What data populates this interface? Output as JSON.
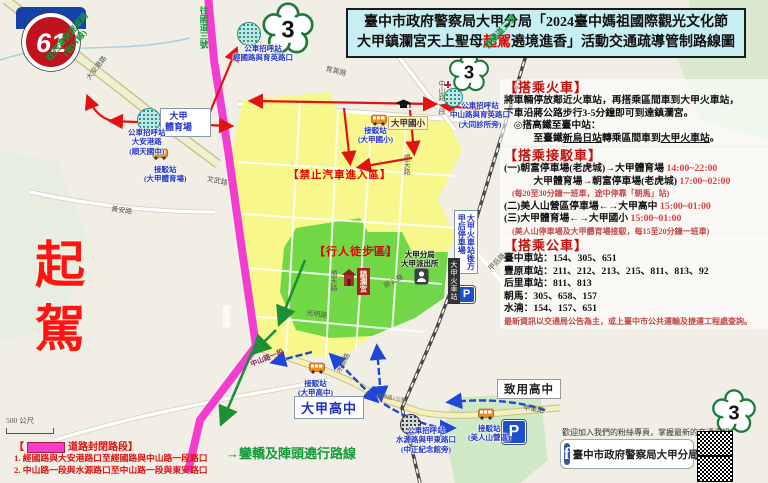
{
  "title": {
    "line1": "臺中市政府警察局大甲分局「2024臺中媽祖國際觀光文化節",
    "line2_pre": "大甲鎮瀾宮天上聖母",
    "line2_red": "起駕",
    "line2_post": "遶境進香」活動交通疏導管制路線圖"
  },
  "badges": {
    "expressway": "61",
    "freeway": "3"
  },
  "big_label": {
    "text": "起駕"
  },
  "panels": [
    {
      "id": "train",
      "header": "【搭乘火車】",
      "lines": [
        {
          "segs": [
            [
              "將車輛停放鄰近火車站，再搭乘區間車到大甲火車站，",
              "k"
            ]
          ]
        },
        {
          "segs": [
            [
              "下車沿蔣公路步行3-5分鐘即可到達鎮瀾宮。",
              "k"
            ]
          ]
        },
        {
          "segs": [
            [
              "　◎搭高鐵至臺中站：",
              "k"
            ]
          ]
        },
        {
          "segs": [
            [
              "　　　至臺鐵",
              "k"
            ],
            [
              "新烏日站",
              "u"
            ],
            [
              "轉乘區間車到",
              "k"
            ],
            [
              "大甲火車站",
              "u"
            ],
            [
              "。",
              "k"
            ]
          ]
        }
      ]
    },
    {
      "id": "shuttle",
      "header": "【搭乘接駁車】",
      "lines": [
        {
          "segs": [
            [
              "(一)朝富停車場(老虎城)→大甲體育場 ",
              "k"
            ],
            [
              "14:00~22:00",
              "r"
            ]
          ]
        },
        {
          "segs": [
            [
              "　　　大甲體育場→朝富停車場(老虎城) ",
              "k"
            ],
            [
              "17:00~02:00",
              "r"
            ]
          ]
        },
        {
          "segs": [
            [
              "　(每20至30分鐘一班車，途中停靠「朝馬」站)",
              "s"
            ]
          ]
        },
        {
          "segs": [
            [
              "(二)美人山營區停車場←→大甲高中 ",
              "k"
            ],
            [
              "15:00~01:00",
              "r"
            ]
          ]
        },
        {
          "segs": [
            [
              "(三)大甲體育場←→大甲國小 ",
              "k"
            ],
            [
              "15:00~01:00",
              "r"
            ]
          ]
        },
        {
          "segs": [
            [
              "　(美人山停車場及大甲體育場接駁，每15至20分鐘一班車)",
              "s"
            ]
          ]
        }
      ]
    },
    {
      "id": "bus",
      "header": "【搭乘公車】",
      "lines": [
        {
          "segs": [
            [
              "臺中車站：154、305、651",
              "k"
            ]
          ]
        },
        {
          "segs": [
            [
              "豐原車站：211、212、213、215、811、813、92",
              "k"
            ]
          ]
        },
        {
          "segs": [
            [
              "后里車站：811、813",
              "k"
            ]
          ]
        },
        {
          "segs": [
            [
              "朝馬：305、658、157",
              "k"
            ]
          ]
        },
        {
          "segs": [
            [
              "水湳：154、157、651",
              "k"
            ]
          ]
        },
        {
          "segs": [
            [
              "最新資訊以交通局公告為主，或上臺中市公共運輸及捷運工程處查詢。",
              "s"
            ]
          ]
        }
      ]
    }
  ],
  "legend": {
    "prefix": "【",
    "label": "道路封閉路段】",
    "items": [
      "1. 經國路與大安港路口至經國路與中山路一段路口",
      "2. 中山路一段與水源路口至中山路一段與東安路口"
    ]
  },
  "route_note": "→鑾轎及陣頭遶行路線",
  "scalebar": {
    "label": "500 公尺"
  },
  "fanpage": {
    "invite": "歡迎加入我們的粉絲專頁，掌握最新的交通資訊",
    "page": "臺中市政府警察局大甲分局"
  },
  "icons": {
    "parking": "P",
    "facebook": "f"
  },
  "map": {
    "labels": [
      {
        "n": "bus-stop-jingguo-yuying",
        "t": "公車招呼站\n經國路與育英路口",
        "x": 233,
        "y": 44,
        "c": "blue"
      },
      {
        "n": "stadium-label",
        "t": "大甲\n體育場",
        "x": 160,
        "y": 108,
        "c": "blue-box"
      },
      {
        "n": "bus-stop-daangang",
        "t": "公車招呼站\n大安港路\n(順天國中)",
        "x": 128,
        "y": 128,
        "c": "blue"
      },
      {
        "n": "shuttle-stop-stadium",
        "t": "接駁站\n(大甲體育場)",
        "x": 144,
        "y": 165,
        "c": "blue"
      },
      {
        "n": "bus-stop-zhongshan-yuying",
        "t": "公車招呼站\n中山路與育英路口\n(大同診所旁)",
        "x": 450,
        "y": 101,
        "c": "blue"
      },
      {
        "n": "shuttle-stop-elementary",
        "t": "接駁站\n(大甲國小)",
        "x": 358,
        "y": 126,
        "c": "blue"
      },
      {
        "n": "dajia-elementary-label",
        "t": "大甲國小",
        "x": 388,
        "y": 116,
        "c": "yellow-box"
      },
      {
        "n": "no-car-zone-label",
        "t": "【禁止汽車進入區】",
        "x": 288,
        "y": 167,
        "c": "redzone"
      },
      {
        "n": "pedestrian-zone-label",
        "t": "【行人徒步區】",
        "x": 314,
        "y": 243,
        "c": "redzone2"
      },
      {
        "n": "jenn-lann-temple-label",
        "t": "鎮瀾宮",
        "x": 357,
        "y": 268,
        "c": "temple",
        "v": true
      },
      {
        "n": "police-station-label",
        "t": "大甲分局\n大甲派出所",
        "x": 401,
        "y": 250,
        "c": "black-sm"
      },
      {
        "n": "jiahou-parking-label",
        "t": "大甲火車站後方\n甲后停車場",
        "x": 454,
        "y": 210,
        "c": "blue-vert",
        "v": true
      },
      {
        "n": "train-station-label",
        "t": "大甲火車站",
        "x": 448,
        "y": 258,
        "c": "rail",
        "v": true
      },
      {
        "n": "shuttle-stop-highschool",
        "t": "接駁站\n(大甲高中)",
        "x": 298,
        "y": 379,
        "c": "blue"
      },
      {
        "n": "dajia-highschool-label",
        "t": "大甲高中",
        "x": 294,
        "y": 396,
        "c": "blue-box-lg"
      },
      {
        "n": "bus-stop-shuiyuan",
        "t": "公車招呼站\n水源路與甲東路口\n(中正紀念館旁)",
        "x": 396,
        "y": 426,
        "c": "blue"
      },
      {
        "n": "shuttle-stop-meirenshan",
        "t": "接駁站\n(美人山營區)",
        "x": 468,
        "y": 424,
        "c": "blue"
      },
      {
        "n": "zhiyong-highschool-label",
        "t": "致用高中",
        "x": 497,
        "y": 379,
        "c": "black-box"
      },
      {
        "n": "expressway-direction",
        "t": "往西濱快速道路\n(台61線)",
        "x": 44,
        "y": 56,
        "c": "green-dir",
        "r": -50
      },
      {
        "n": "freeway3-direction-north",
        "t": "往國道三號",
        "x": 198,
        "y": 6,
        "c": "green-vert",
        "v": true
      },
      {
        "n": "freeway3-direction-east",
        "t": "往國道三號",
        "x": 482,
        "y": 44,
        "c": "green-dir",
        "r": -48
      },
      {
        "n": "route-daangang",
        "t": "大安港路",
        "x": 84,
        "y": 76,
        "c": "road",
        "r": -52
      },
      {
        "n": "route-yuying",
        "t": "育英路",
        "x": 327,
        "y": 64,
        "c": "road",
        "r": 14
      },
      {
        "n": "route-wenwu-1",
        "t": "文武路",
        "x": 208,
        "y": 174,
        "c": "road",
        "r": 12
      },
      {
        "n": "route-wenwu-2",
        "t": "文武路",
        "x": 371,
        "y": 244,
        "c": "road",
        "r": 12
      },
      {
        "n": "route-huangan",
        "t": "黃安路",
        "x": 112,
        "y": 204,
        "c": "road",
        "r": 8
      },
      {
        "n": "route-jingguo",
        "t": "經國路",
        "x": 221,
        "y": 305,
        "c": "pinkroad",
        "v": true
      },
      {
        "n": "route-shuntian-1",
        "t": "順天路",
        "x": 329,
        "y": 270,
        "c": "road",
        "v": true
      },
      {
        "n": "route-shuntian-2",
        "t": "順天路",
        "x": 402,
        "y": 154,
        "c": "road",
        "v": true
      },
      {
        "n": "route-jianggong",
        "t": "蔣公路",
        "x": 382,
        "y": 282,
        "c": "road",
        "r": -28
      },
      {
        "n": "route-guangming",
        "t": "光明路",
        "x": 307,
        "y": 308,
        "c": "road",
        "r": 8
      },
      {
        "n": "route-zhongshan-1",
        "t": "中山路一段",
        "x": 249,
        "y": 360,
        "c": "pinkroad2",
        "r": -22
      },
      {
        "n": "route-zhongshan-2",
        "t": "中山路一段",
        "x": 437,
        "y": 80,
        "c": "road",
        "v": true
      },
      {
        "n": "route-shuiyuan",
        "t": "水源路",
        "x": 334,
        "y": 370,
        "c": "road",
        "r": -62
      },
      {
        "n": "route-shuiyuan-135",
        "t": "水源路135巷",
        "x": 377,
        "y": 391,
        "c": "road-xs",
        "r": 10
      },
      {
        "n": "route-jiadong",
        "t": "甲東路",
        "x": 524,
        "y": 403,
        "c": "road",
        "r": 8
      },
      {
        "n": "route-jiahou",
        "t": "甲后路",
        "x": 486,
        "y": 266,
        "c": "road",
        "r": -45
      }
    ]
  }
}
